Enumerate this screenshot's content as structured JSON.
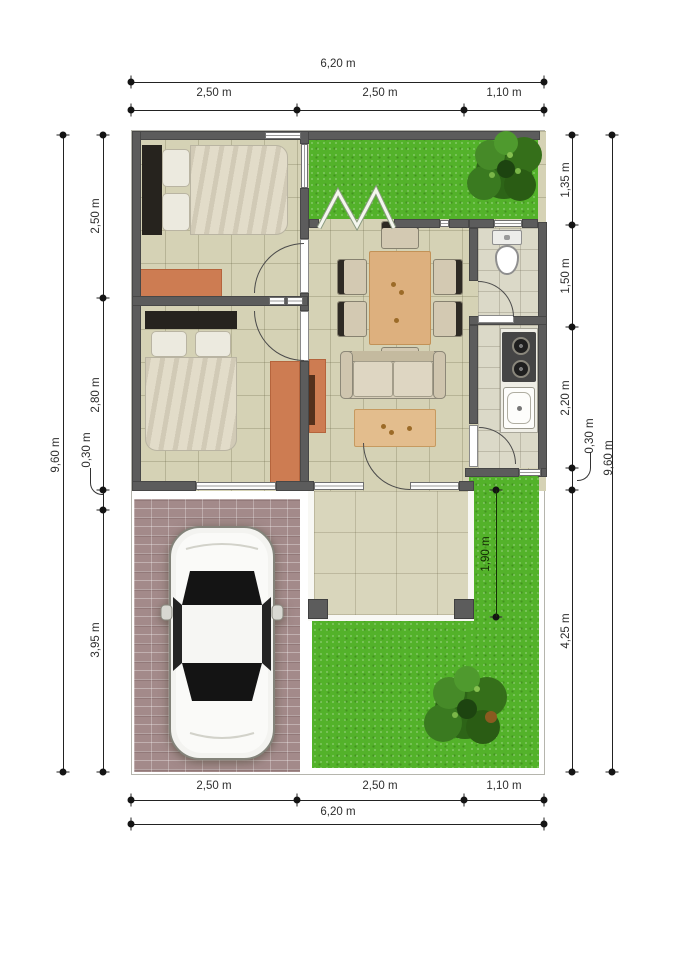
{
  "dimensions": {
    "top": {
      "total": "6,20 m",
      "segments": [
        "2,50 m",
        "2,50 m",
        "1,10 m"
      ]
    },
    "bottom": {
      "total": "6,20 m",
      "segments": [
        "2,50 m",
        "2,50 m",
        "1,10 m"
      ]
    },
    "left": {
      "total": "9,60 m",
      "segments": [
        "2,50 m",
        "2,80 m",
        "0,30 m",
        "3,95 m"
      ]
    },
    "right": {
      "total": "9,60 m",
      "segments": [
        "1,35 m",
        "1,50 m",
        "2,20 m",
        "0,30 m",
        "4,25 m"
      ]
    },
    "porch": {
      "depth": "1,90 m"
    }
  },
  "colors": {
    "wall": "#5c5c5c",
    "floor_tile": "#d5d2b5",
    "grass": "#53b22a",
    "paver": "#a38a8a",
    "rug": "#cd7c52",
    "wood": "#ddb07e",
    "upholstery": "#d6cdb8",
    "dimension_text": "#2e2e2e"
  }
}
